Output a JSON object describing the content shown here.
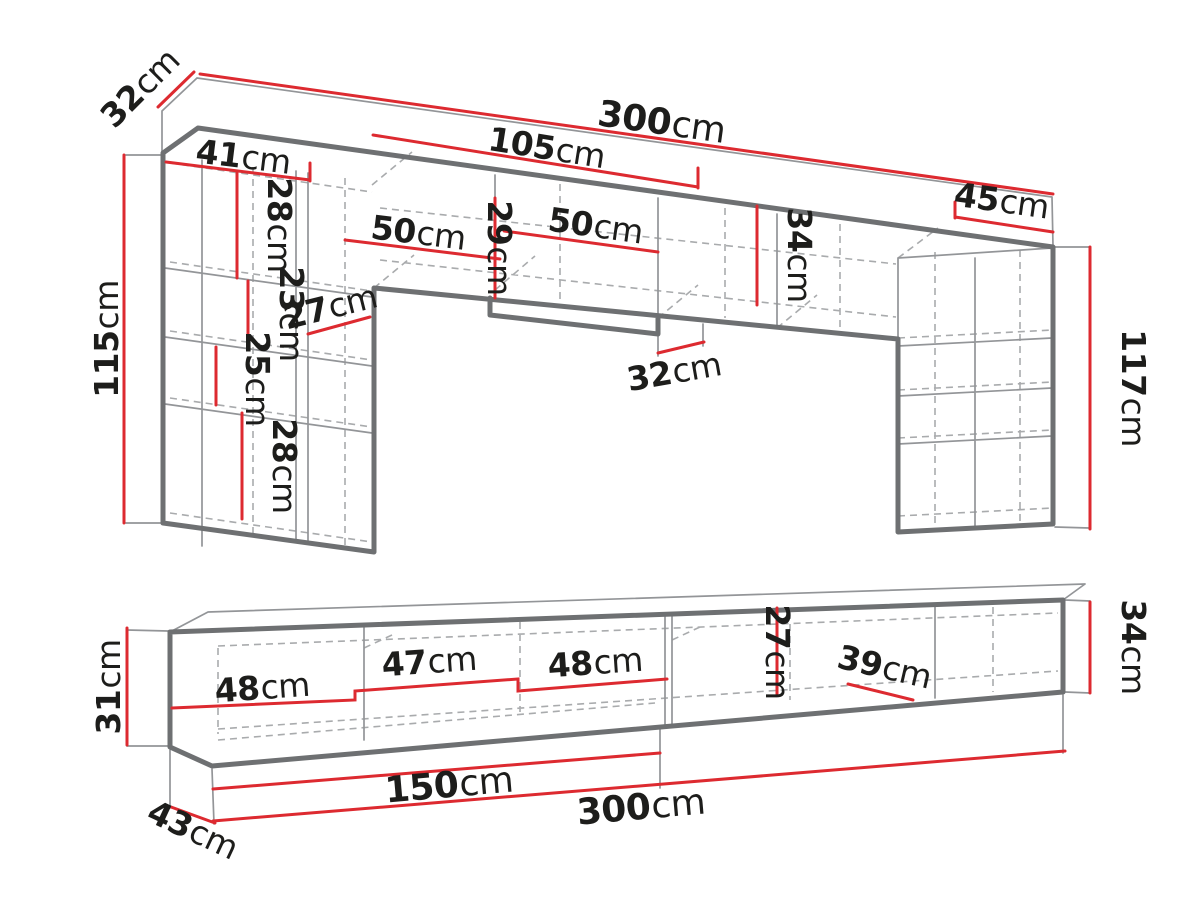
{
  "diagram": {
    "kind": "furniture dimension drawing",
    "views": [
      "wall unit upper section",
      "tv stand lower section"
    ]
  },
  "colors": {
    "dimension_line": "#dd2a30",
    "outline_dark": "#6e7072",
    "outline_mid": "#939598",
    "outline_dashed": "#a9abad",
    "label_text": "#1d1d1b",
    "background": "#ffffff"
  },
  "dims": {
    "top_depth_32": {
      "num": "32",
      "unit": "cm"
    },
    "top_width_300": {
      "num": "300",
      "unit": "cm"
    },
    "top_mid_width_105": {
      "num": "105",
      "unit": "cm"
    },
    "top_right_width_45": {
      "num": "45",
      "unit": "cm"
    },
    "left_col_height_115": {
      "num": "115",
      "unit": "cm"
    },
    "right_col_height_117": {
      "num": "117",
      "unit": "cm"
    },
    "shelf_41": {
      "num": "41",
      "unit": "cm"
    },
    "upper_gap_28": {
      "num": "28",
      "unit": "cm"
    },
    "inner_gap_23": {
      "num": "23",
      "unit": "cm"
    },
    "shelf_27": {
      "num": "27",
      "unit": "cm"
    },
    "inner_gap_25": {
      "num": "25",
      "unit": "cm"
    },
    "lower_gap_28": {
      "num": "28",
      "unit": "cm"
    },
    "comp_50_left": {
      "num": "50",
      "unit": "cm"
    },
    "bridge_gap_29": {
      "num": "29",
      "unit": "cm"
    },
    "comp_50_right": {
      "num": "50",
      "unit": "cm"
    },
    "bridge_gap_34": {
      "num": "34",
      "unit": "cm"
    },
    "mid_depth_32": {
      "num": "32",
      "unit": "cm"
    },
    "tv_height_31": {
      "num": "31",
      "unit": "cm"
    },
    "tv_comp_48_left": {
      "num": "48",
      "unit": "cm"
    },
    "tv_comp_47": {
      "num": "47",
      "unit": "cm"
    },
    "tv_comp_48_right": {
      "num": "48",
      "unit": "cm"
    },
    "tv_gap_27": {
      "num": "27",
      "unit": "cm"
    },
    "tv_comp_39": {
      "num": "39",
      "unit": "cm"
    },
    "tv_height_34": {
      "num": "34",
      "unit": "cm"
    },
    "tv_width_150": {
      "num": "150",
      "unit": "cm"
    },
    "tv_width_300": {
      "num": "300",
      "unit": "cm"
    },
    "tv_depth_43": {
      "num": "43",
      "unit": "cm"
    }
  }
}
